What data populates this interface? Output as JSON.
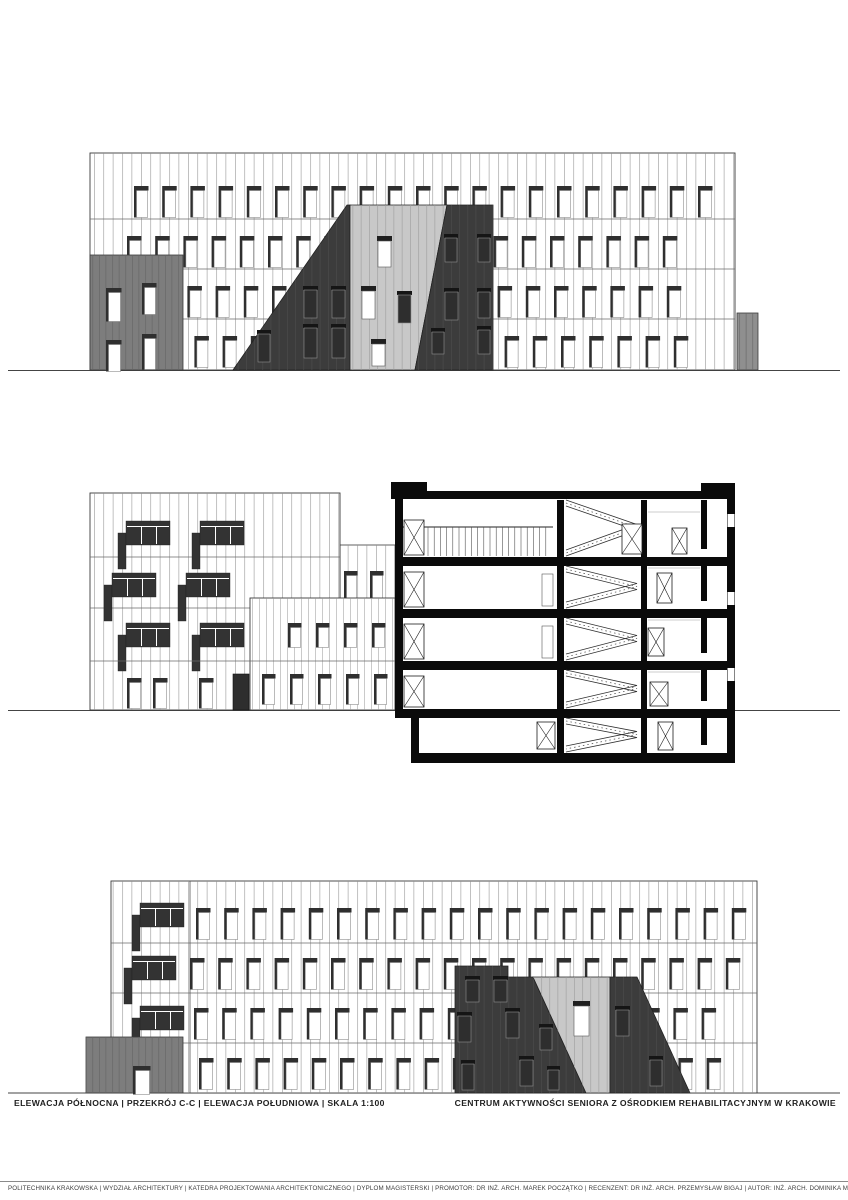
{
  "captions": {
    "drawings_list": "ELEWACJA PÓŁNOCNA |  PRZEKRÓJ C-C |  ELEWACJA POŁUDNIOWA |  SKALA 1:100",
    "project_title": "CENTRUM AKTYWNOŚCI SENIORA Z OŚRODKIEM REHABILITACYJNYM W KRAKOWIE"
  },
  "drawings": [
    {
      "id": "north-elevation",
      "label": "ELEWACJA PÓŁNOCNA"
    },
    {
      "id": "section-cc",
      "label": "PRZEKRÓJ C-C"
    },
    {
      "id": "south-elevation",
      "label": "ELEWACJA POŁUDNIOWA"
    }
  ],
  "scale_note": "SKALA 1:100",
  "footer": {
    "credits": "POLITECHNIKA KRAKOWSKA |  WYDZIAŁ ARCHITEKTURY |  KATEDRA PROJEKTOWANIA ARCHITEKTONICZNEGO |  DYPLOM MAGISTERSKI |  PROMOTOR: DR INŻ. ARCH. MAREK POCZĄTKO |  RECENZENT: DR INŻ. ARCH. PRZEMYSŁAW BIGAJ |  AUTOR: INŻ. ARCH. DOMINIKA MRÓZ | ROK 2022/2023"
  },
  "colors": {
    "paper": "#ffffff",
    "ink": "#2f2f2f",
    "dark_cladding": "#3c3c3c",
    "mid_gray_cladding": "#7d7d7d",
    "light_gray_cladding": "#c8c8c8",
    "small_gray_block": "#8f8f8f",
    "poche_black": "#0a0a0a"
  }
}
